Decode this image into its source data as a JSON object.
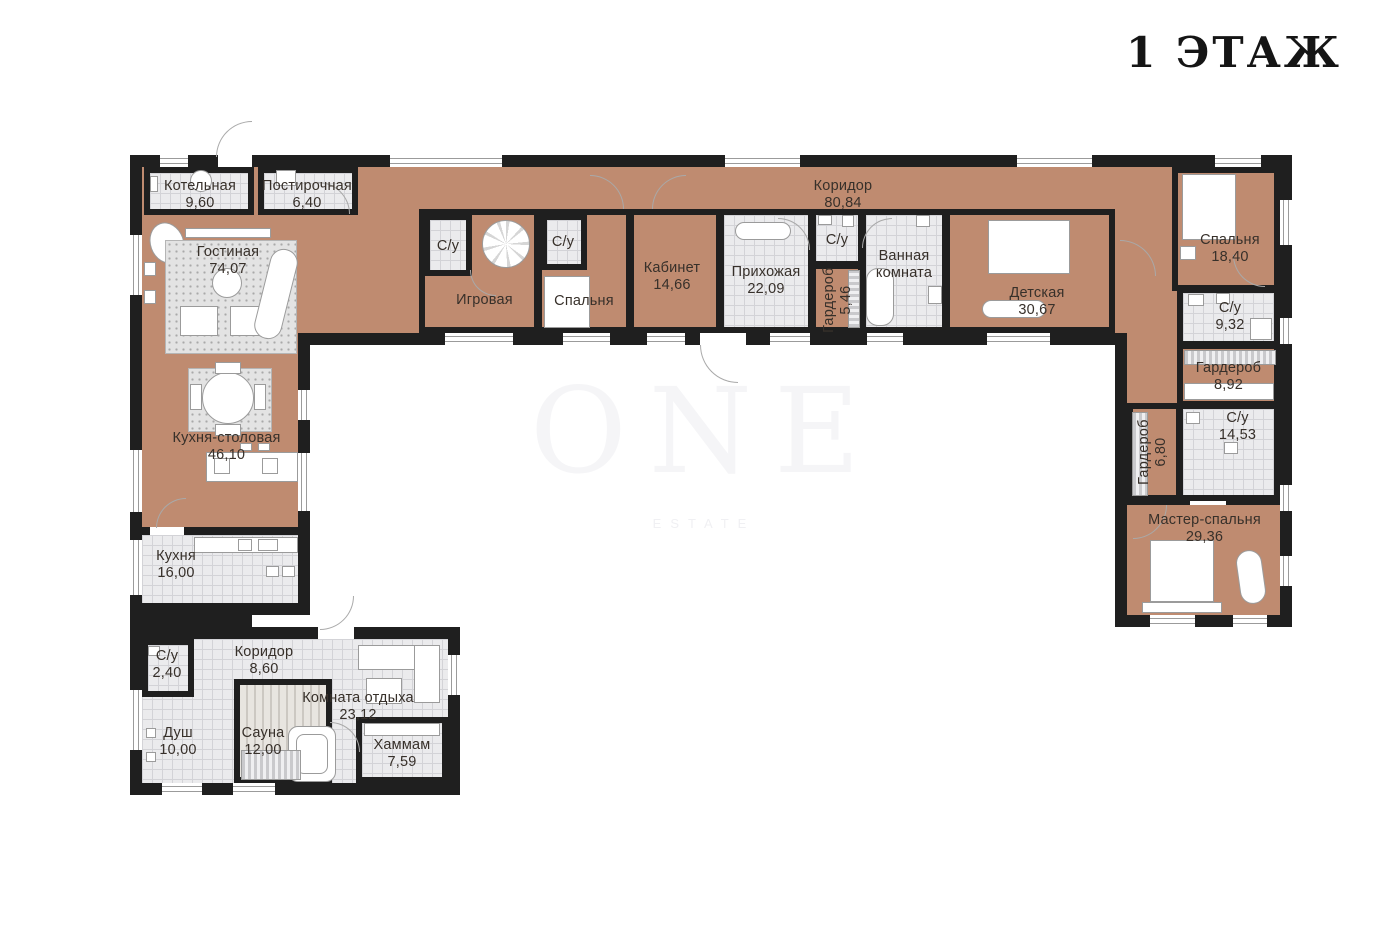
{
  "title": "1 ЭТАЖ",
  "watermark": {
    "line1": "ONE",
    "line2": "ESTATE"
  },
  "colors": {
    "wall": "#1f1f1f",
    "floor": "#bf8b70",
    "tile": "#ebebed",
    "background": "#ffffff"
  },
  "rooms": {
    "boiler": {
      "name": "Котельная",
      "area": "9,60"
    },
    "laundry": {
      "name": "Постирочная",
      "area": "6,40"
    },
    "living": {
      "name": "Гостиная",
      "area": "74,07"
    },
    "corridor_main": {
      "name": "Коридор",
      "area": "80,84"
    },
    "su_game": {
      "name": "С/у"
    },
    "game": {
      "name": "Игровая"
    },
    "su_bedroom": {
      "name": "С/у"
    },
    "bedroom_small": {
      "name": "Спальня"
    },
    "office": {
      "name": "Кабинет",
      "area": "14,66"
    },
    "hallway": {
      "name": "Прихожая",
      "area": "22,09"
    },
    "su_hall": {
      "name": "С/у"
    },
    "wardrobe_hall": {
      "name": "Гардероб",
      "area": "5,46"
    },
    "bathroom": {
      "name": "Ванная комната"
    },
    "children": {
      "name": "Детская",
      "area": "30,67"
    },
    "bedroom2": {
      "name": "Спальня",
      "area": "18,40"
    },
    "su_932": {
      "name": "С/у",
      "area": "9,32"
    },
    "wardrobe_892": {
      "name": "Гардероб",
      "area": "8,92"
    },
    "wardrobe_680": {
      "name": "Гардероб",
      "area": "6,80"
    },
    "su_1453": {
      "name": "С/у",
      "area": "14,53"
    },
    "master": {
      "name": "Мастер-спальня",
      "area": "29,36"
    },
    "kitchen_dining": {
      "name": "Кухня-столовая",
      "area": "46,10"
    },
    "kitchen": {
      "name": "Кухня",
      "area": "16,00"
    },
    "su_240": {
      "name": "С/у",
      "area": "2,40"
    },
    "corridor_spa": {
      "name": "Коридор",
      "area": "8,60"
    },
    "shower": {
      "name": "Душ",
      "area": "10,00"
    },
    "sauna": {
      "name": "Сауна",
      "area": "12,00"
    },
    "lounge": {
      "name": "Комната отдыха",
      "area": "23,12"
    },
    "hammam": {
      "name": "Хаммам",
      "area": "7,59"
    }
  }
}
